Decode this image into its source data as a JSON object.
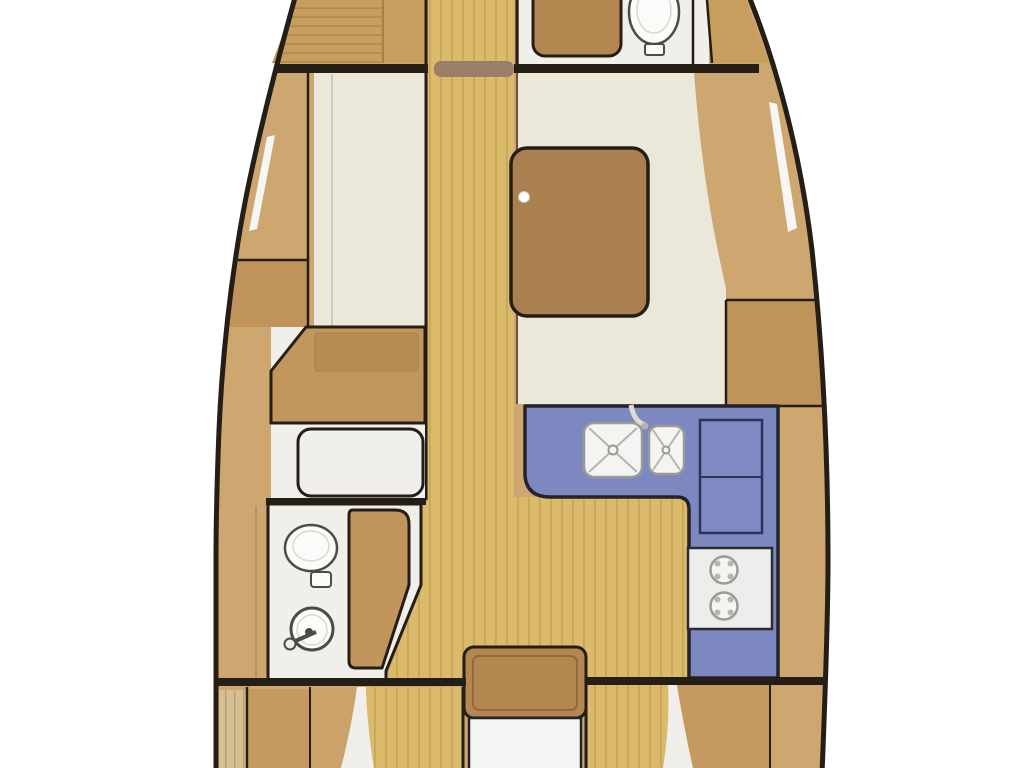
{
  "diagram": {
    "type": "yacht-interior-floor-plan",
    "orientation": "bow-up",
    "visible_text": ""
  },
  "colors": {
    "bg": "#ffffff",
    "outline": "#241e16",
    "hull_lining": "#cda76f",
    "berth_tan": "#c79e5e",
    "berth_seam": "#ae8850",
    "panel_tan": "#c49a61",
    "panel_tan2": "#cba26a",
    "cabinet_tan": "#c0935b",
    "floor_wood": "#dcba6b",
    "floor_slat": "#c9a759",
    "stripe_base": "#d6bf92",
    "stripe_line": "#b9a276",
    "cream": "#ebe7d9",
    "white_floor": "#f1efe9",
    "fixture_white": "#fbfbfa",
    "fixture_stroke": "#4c4c46",
    "fixture_inner": "#d8d8d2",
    "table_brown": "#aa8050",
    "seat_brown": "#b3874f",
    "desk_tan": "#c2965c",
    "desk_inner": "#b78b51",
    "door_wood": "#c2955c",
    "lintel_brown": "#9b7e68",
    "galley_blue": "#7d87c0",
    "galley_stroke": "#23232c",
    "fridge_blue": "#7f89c3",
    "fridge_stroke": "#2c3558",
    "stove_white": "#ededeb",
    "stove_stroke": "#2c2c34",
    "sink_white": "#f4f4f2",
    "sink_stroke": "#9a9a96",
    "sink_detail": "#b5b5b0",
    "faucet_white": "#dcdad4",
    "window_white": "#f7f6f2",
    "dot_white": "#ffffff",
    "seam_soft": "#a5804c"
  }
}
